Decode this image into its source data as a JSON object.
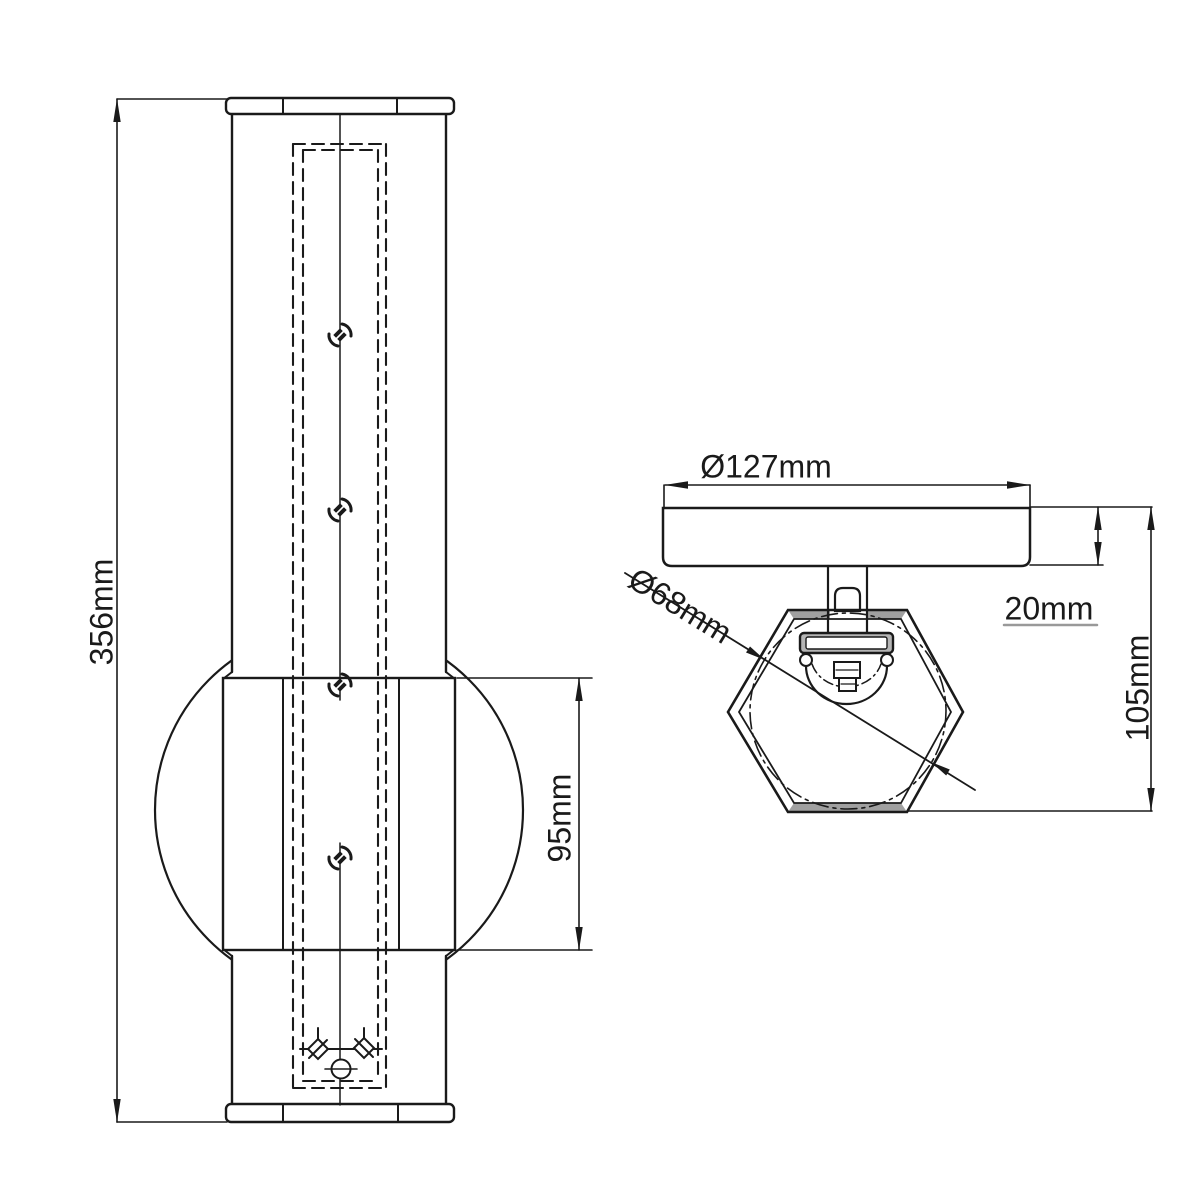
{
  "page": {
    "background": "#ffffff"
  },
  "drawing": {
    "ink": "#1a1a1a",
    "shade_gray": "#a0a0a0",
    "views": [
      {
        "name": "front-elevation-view"
      },
      {
        "name": "top-plan-view"
      }
    ]
  },
  "labels": {
    "overall_height": "356mm",
    "glass_sphere_height": "95mm",
    "canopy_diameter": "Ø127mm",
    "canopy_depth": "20mm",
    "projection_height": "105mm",
    "shade_diameter": "Ø68mm"
  }
}
